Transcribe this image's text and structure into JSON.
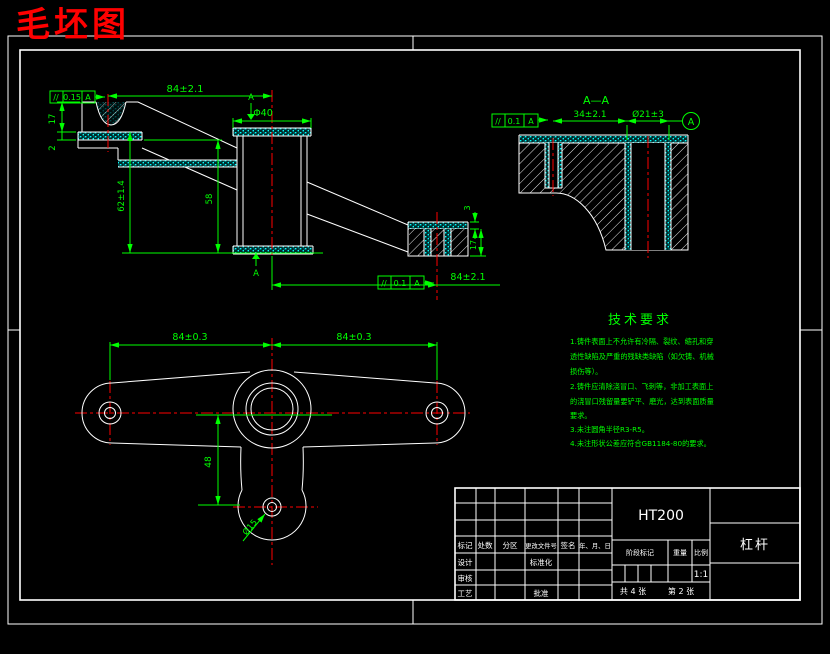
{
  "page_title": "毛坯图",
  "colors": {
    "background": "#000000",
    "part_line": "#ffffff",
    "dimension": "#00ff00",
    "centerline": "#ff0000",
    "allowance": "#00ffff",
    "title": "#ff0000"
  },
  "front_view": {
    "tol_top": {
      "sym": "//",
      "val": "0.15",
      "datum": "A"
    },
    "dim_span_top": "84±2.1",
    "dim_boss_dia": "Φ40",
    "dim_left_height": "17",
    "dim_left_allowance": "2",
    "dim_height_outer": "62±1.4",
    "dim_height_inner": "58",
    "dim_right_allowance": "3",
    "dim_right_height": "17",
    "tol_bottom": {
      "sym": "//",
      "val": "0.1",
      "datum": "A"
    },
    "dim_span_bottom": "84±2.1",
    "datum_top": "A",
    "datum_bottom": "A"
  },
  "section_view": {
    "label": "A—A",
    "tol": {
      "sym": "//",
      "val": "0.1",
      "datum": "A"
    },
    "dim_width": "34±2.1",
    "dim_hole": "Ø21±3",
    "datum_balloon": "A"
  },
  "plan_view": {
    "dim_left": "84±0.3",
    "dim_right": "84±0.3",
    "dim_height": "48",
    "dim_hole": "Ø15"
  },
  "tech_requirements": {
    "title": "技术要求",
    "lines": [
      "1.铸件表面上不允许有冷隔、裂纹、缩孔和穿",
      "透性缺陷及严重的残缺类缺陷（如欠铸、机械",
      "损伤等）。",
      "2.铸件应清除浇冒口、飞刺等，非加工表面上",
      "的浇冒口残留量要铲平、磨光，达到表面质量",
      "要求。",
      "3.未注圆角半径R3-R5。",
      "4.未注形状公差应符合GB1184-80的要求。"
    ]
  },
  "title_block": {
    "material": "HT200",
    "part_name": "杠杆",
    "scale_value": "1:1",
    "sheet_total": "共 4 张",
    "sheet_index": "第 2 张",
    "cols": {
      "mark": "标记",
      "count": "处数",
      "zone": "分区",
      "change_file": "更改文件号",
      "sign": "签名",
      "date": "年、月、日"
    },
    "rows": {
      "design": "设计",
      "standardize": "标准化",
      "check": "审核",
      "process": "工艺",
      "approve": "批准"
    },
    "fields": {
      "stage": "阶段标记",
      "weight": "重量",
      "scale": "比例"
    }
  }
}
